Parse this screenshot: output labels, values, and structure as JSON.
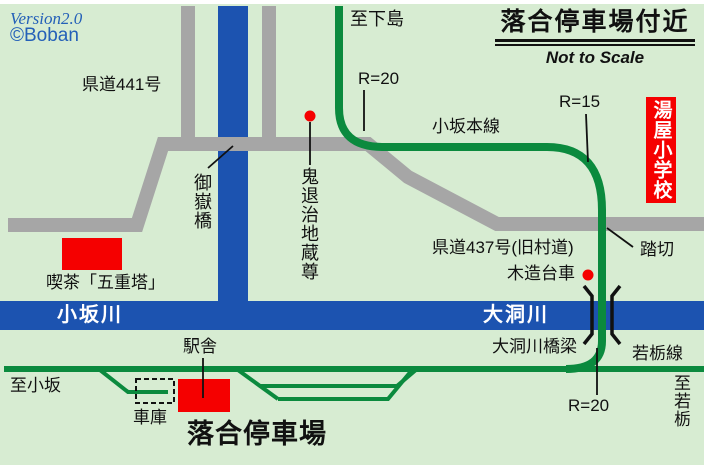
{
  "colors": {
    "bg": "#D7ECD2",
    "road": "#A6A6A6",
    "river": "#1C53B0",
    "rail": "#0B8A3E",
    "red": "#F50000",
    "blue_text": "#2460B8",
    "ink": "#111111",
    "white": "#FFFFFF"
  },
  "meta": {
    "version": "Version2.0",
    "credit": "©Boban"
  },
  "header": {
    "title": "落合停車場付近",
    "subtitle": "Not to Scale"
  },
  "labels": {
    "to_shimojima": "至下島",
    "r20_top": "R=20",
    "route441": "県道441号",
    "kosaka_main_line": "小坂本線",
    "r15": "R=15",
    "yuya_school": "湯屋小学校",
    "ontake_bridge": "御嶽橋",
    "oni_jizo": "鬼退治地蔵尊",
    "cafe": "喫茶「五重塔」",
    "route437": "県道437号(旧村道)",
    "crossing": "踏切",
    "wooden_bogie": "木造台車",
    "kosaka_river": "小坂川",
    "obora_river": "大洞川",
    "obora_bridge": "大洞川橋梁",
    "wakatochi_line": "若栃線",
    "to_wakatochi": "至若栃",
    "r20_bottom": "R=20",
    "to_kosaka": "至小坂",
    "depot": "車庫",
    "station_building": "駅舎",
    "station_name": "落合停車場"
  }
}
